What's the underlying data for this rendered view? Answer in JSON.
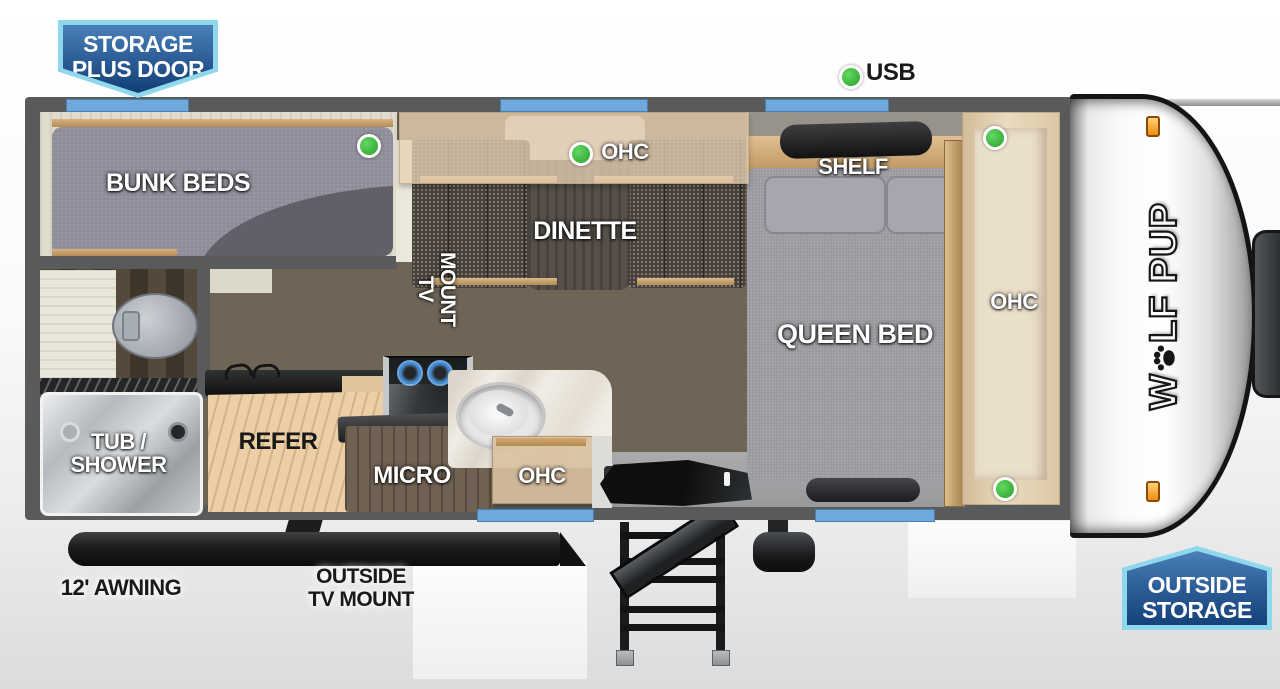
{
  "callouts": {
    "storage_plus_door_line1": "STORAGE",
    "storage_plus_door_line2": "PLUS DOOR",
    "outside_storage_line1": "OUTSIDE",
    "outside_storage_line2": "STORAGE",
    "usb": "USB",
    "awning": "12' AWNING",
    "outside_tv_mount_line1": "OUTSIDE",
    "outside_tv_mount_line2": "TV MOUNT"
  },
  "floorplan": {
    "bunk_beds": "BUNK BEDS",
    "tv_mount_line1": "TV",
    "tv_mount_line2": "MOUNT",
    "dinette": "DINETTE",
    "dinette_ohc": "OHC",
    "shelf": "SHELF",
    "queen_bed": "QUEEN BED",
    "wardrobe_ohc": "OHC",
    "tub_shower_line1": "TUB /",
    "tub_shower_line2": "SHOWER",
    "refer": "REFER",
    "micro": "MICRO",
    "kitchen_ohc": "OHC"
  },
  "brand": {
    "name": "WOLF PUP",
    "logo_prefix": "W",
    "logo_suffix": "LF PUP"
  },
  "colors": {
    "wall_gray": "#595a5c",
    "window_blue": "#6fa8dc",
    "badge_blue_dark": "#123d74",
    "badge_blue_light": "#4a80b8",
    "badge_border_cyan": "#8fd7ec",
    "led_green": "#2da32d",
    "marker_orange": "#ef8c0e"
  }
}
